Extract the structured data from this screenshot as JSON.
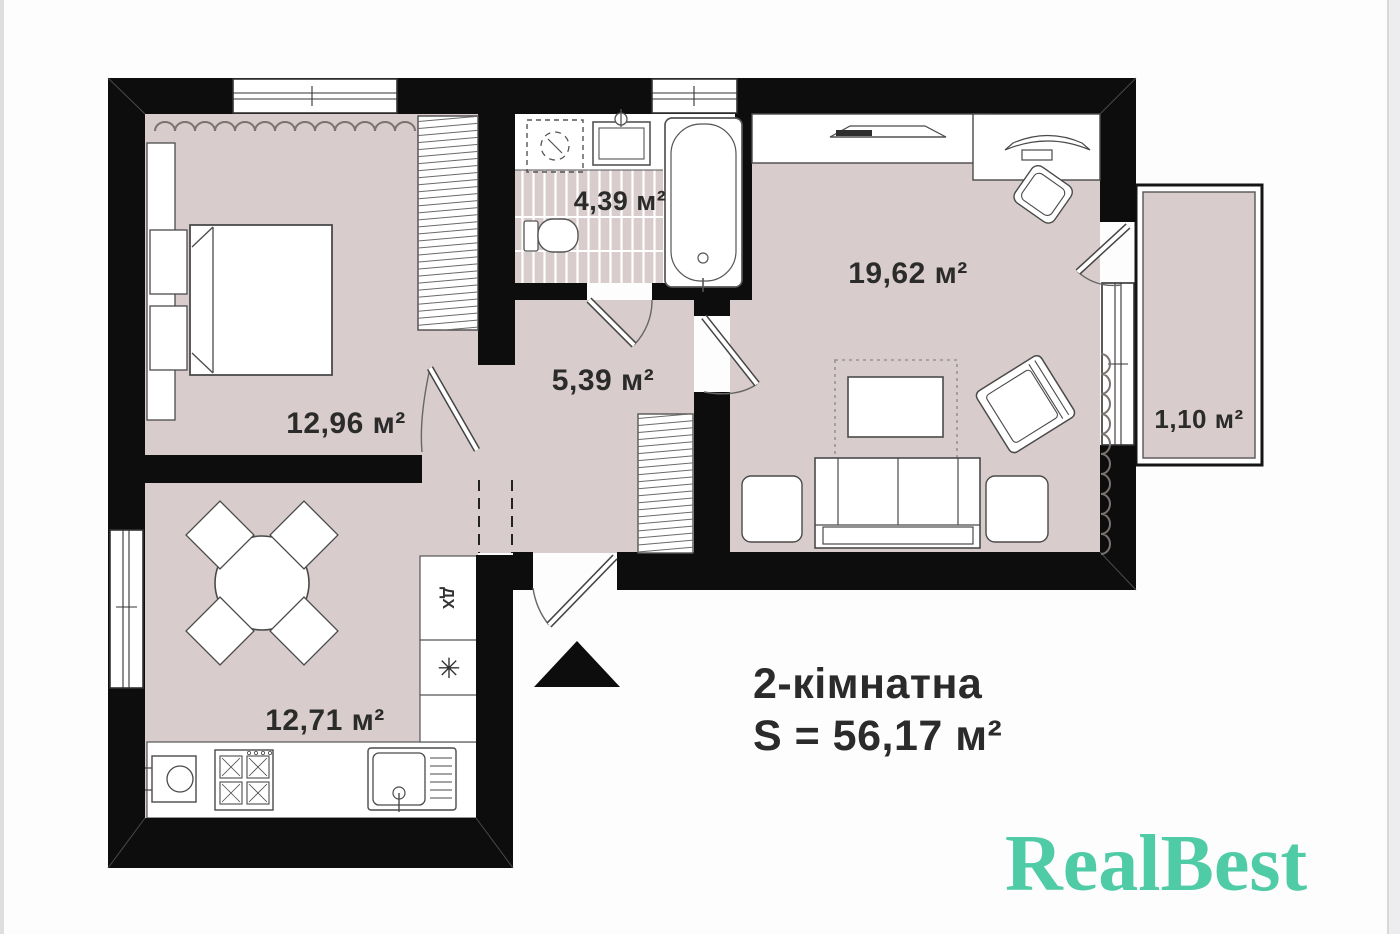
{
  "plan": {
    "title_line1": "2-кімнатна",
    "title_line2": "S = 56,17 м²",
    "rooms": {
      "bedroom": {
        "area_label": "12,96 м²"
      },
      "bathroom": {
        "area_label": "4,39 м²"
      },
      "hallway": {
        "area_label": "5,39 м²"
      },
      "living_room": {
        "area_label": "19,62 м²"
      },
      "kitchen": {
        "area_label": "12,71 м²"
      },
      "balcony": {
        "area_label": "1,10 м²"
      }
    },
    "kitchen_unit": {
      "fridge_label": "ДХ",
      "freezer_symbol": "✳"
    }
  },
  "branding": {
    "logo_text": "RealBest",
    "logo_color": "#4fcba6"
  },
  "colors": {
    "walls": "#0d0d0d",
    "floor_fill": "#d8cdcc",
    "label_text": "#2b2b2b"
  }
}
